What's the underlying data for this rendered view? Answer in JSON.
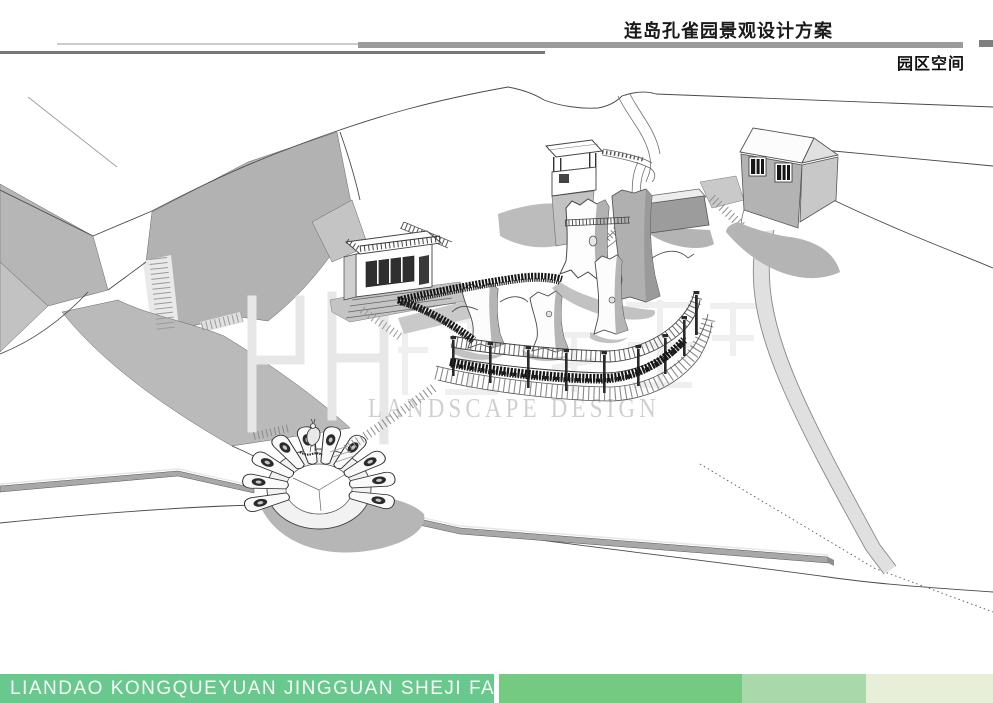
{
  "header": {
    "title": "连岛孔雀园景观设计方案",
    "subtitle": "园区空间"
  },
  "watermark": {
    "text": "LANDSCAPE DESIGN",
    "logo_icon": "hj-monogram-watermark"
  },
  "footer": {
    "caption": "LIANDAO KONGQUEYUAN JINGGUAN SHEJI FANGAN"
  },
  "colors": {
    "accent_green": "#69c88e",
    "green_mid": "#75ca81",
    "green_light": "#a9d8ab",
    "green_pale": "#e7efd8",
    "header_bar_gray": "#9b9b9b",
    "header_line_dark": "#787878",
    "cliff_gray": "#b2b2b2",
    "shadow_gray": "#b6b6b6",
    "watermark_gray": "#c9c9c9",
    "ink": "#4a4a4a"
  }
}
